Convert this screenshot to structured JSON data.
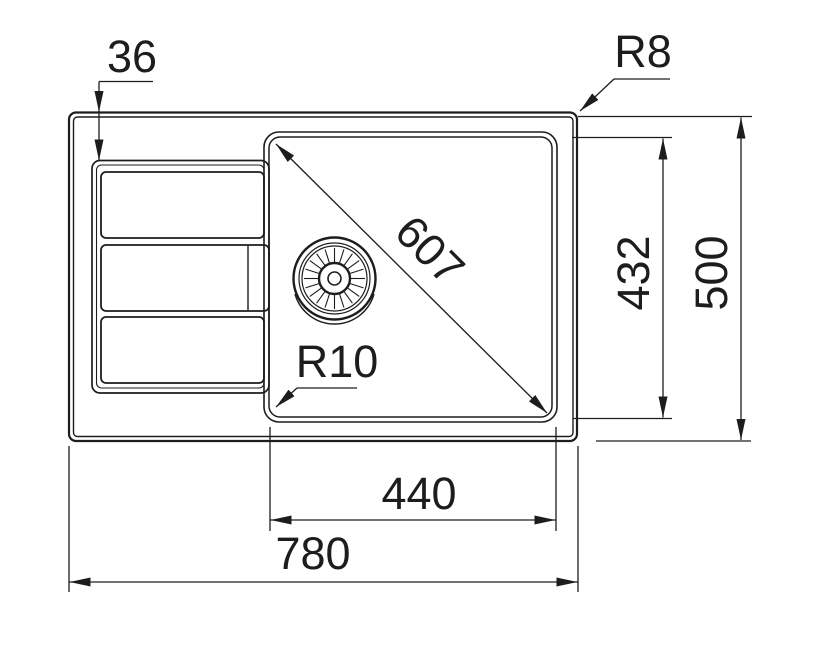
{
  "drawing": {
    "background_color": "#ffffff",
    "line_color": "#1d1d1b",
    "view": "sink-top-view-technical-drawing",
    "dimensions": {
      "edge_offset": {
        "label": "36"
      },
      "outer_corner_radius": {
        "label": "R8"
      },
      "bowl_diagonal": {
        "label": "607"
      },
      "bowl_depth": {
        "label": "432"
      },
      "overall_depth": {
        "label": "500"
      },
      "bowl_corner_radius": {
        "label": "R10"
      },
      "bowl_width": {
        "label": "440"
      },
      "overall_width": {
        "label": "780"
      }
    }
  }
}
